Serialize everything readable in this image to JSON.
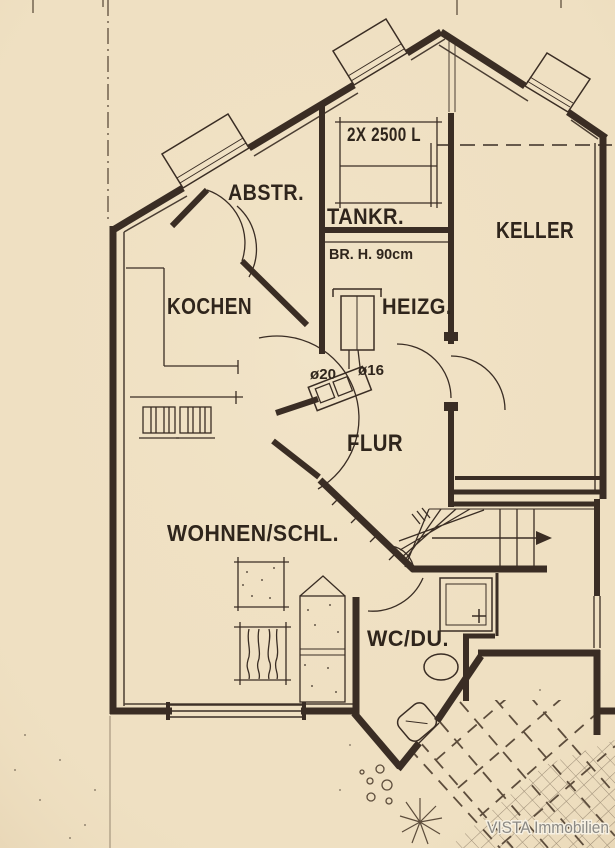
{
  "colors": {
    "paper": "#efe0c2",
    "ink": "#3a2d24",
    "watermark_gray": "#8c8a85"
  },
  "plan": {
    "rooms": {
      "abstellraum": "ABSTR.",
      "tankraum": "TANKR.",
      "keller": "KELLER",
      "kochen": "KOCHEN",
      "heizung": "HEIZG.",
      "flur": "FLUR",
      "wohnen_schlafen": "WOHNEN/SCHL.",
      "wc_dusche": "WC/DU."
    },
    "annotations": {
      "tank_capacity": "2X 2500 L",
      "parapet_height": "BR. H. 90cm",
      "pipe_20": "ø20",
      "pipe_16": "ø16"
    },
    "watermark": "VISTA Immobilien"
  }
}
